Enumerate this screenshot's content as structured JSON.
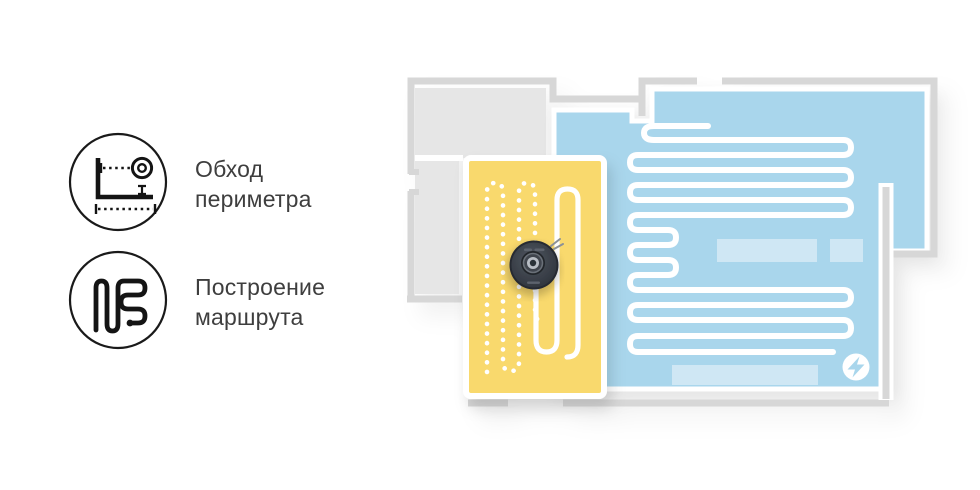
{
  "features": [
    {
      "icon": "perimeter-traversal-icon",
      "line1": "Обход",
      "line2": "периметра"
    },
    {
      "icon": "route-building-icon",
      "line1": "Построение",
      "line2": "маршрута"
    }
  ],
  "floorplan": {
    "robot": "robot-vacuum",
    "dock_icon": "charging-bolt-icon",
    "colors": {
      "wall": "#d7d7d7",
      "unmapped_room": "#e6e6e6",
      "mapped_room": "#a9d6ec",
      "furniture": "#cfe7f4",
      "active_room": "#f9d96d",
      "path": "#ffffff",
      "dock_bolt": "#a9d6ec"
    }
  }
}
